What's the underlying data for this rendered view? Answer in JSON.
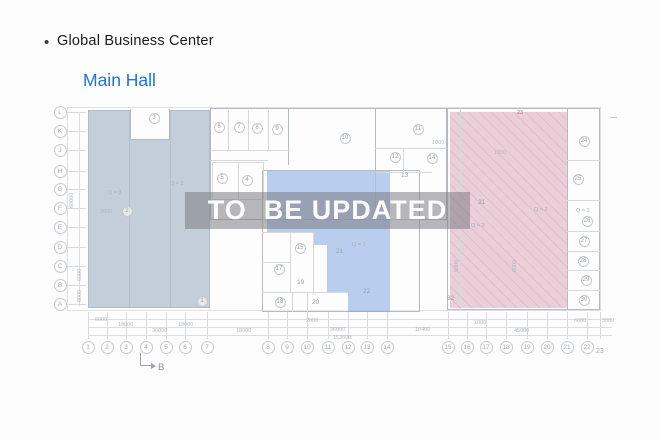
{
  "header": {
    "bullet": "•",
    "title": "Global Business Center",
    "subtitle": "Main Hall"
  },
  "watermark": {
    "text": "TO  BE UPDATED"
  },
  "colors": {
    "link_blue": "#2273cf",
    "left_region": "rgba(150,168,190,0.55)",
    "middle_region": "rgba(130,165,225,0.55)",
    "right_region": "rgba(215,160,180,0.5)",
    "watermark_band": "rgba(125,125,132,0.55)",
    "wall": "#b6bac2",
    "wall_light": "#d6d8dc",
    "accent_red": "#c36a76"
  },
  "grid": {
    "rows": [
      {
        "label": "L",
        "x": 60,
        "y": 112
      },
      {
        "label": "K",
        "x": 60,
        "y": 131
      },
      {
        "label": "J",
        "x": 60,
        "y": 150
      },
      {
        "label": "H",
        "x": 60,
        "y": 171
      },
      {
        "label": "G",
        "x": 60,
        "y": 189
      },
      {
        "label": "F",
        "x": 60,
        "y": 208
      },
      {
        "label": "E",
        "x": 60,
        "y": 227
      },
      {
        "label": "D",
        "x": 60,
        "y": 247
      },
      {
        "label": "C",
        "x": 60,
        "y": 266
      },
      {
        "label": "B",
        "x": 60,
        "y": 285
      },
      {
        "label": "A",
        "x": 60,
        "y": 304
      }
    ],
    "cols": [
      {
        "label": "1",
        "x": 88
      },
      {
        "label": "2",
        "x": 107
      },
      {
        "label": "3",
        "x": 126
      },
      {
        "label": "4",
        "x": 146
      },
      {
        "label": "5",
        "x": 166
      },
      {
        "label": "6",
        "x": 185
      },
      {
        "label": "7",
        "x": 207
      },
      {
        "label": "8",
        "x": 268
      },
      {
        "label": "9",
        "x": 287
      },
      {
        "label": "10",
        "x": 307
      },
      {
        "label": "11",
        "x": 328
      },
      {
        "label": "12",
        "x": 348
      },
      {
        "label": "13",
        "x": 367
      },
      {
        "label": "14",
        "x": 387
      },
      {
        "label": "15",
        "x": 448
      },
      {
        "label": "16",
        "x": 467
      },
      {
        "label": "17",
        "x": 486
      },
      {
        "label": "18",
        "x": 506
      },
      {
        "label": "19",
        "x": 527
      },
      {
        "label": "20",
        "x": 547
      },
      {
        "label": "21",
        "x": 567
      },
      {
        "label": "22",
        "x": 587
      },
      {
        "label": "23",
        "x": 600,
        "cy": 352,
        "plain": true
      }
    ]
  },
  "rooms": [
    {
      "n": "1",
      "x": 202,
      "y": 301,
      "c": true
    },
    {
      "n": "2",
      "x": 127,
      "y": 211,
      "c": true
    },
    {
      "n": "3",
      "x": 154,
      "y": 118,
      "c": true
    },
    {
      "n": "4",
      "x": 247,
      "y": 180,
      "c": true
    },
    {
      "n": "5",
      "x": 222,
      "y": 178,
      "c": true
    },
    {
      "n": "6",
      "x": 219,
      "y": 127,
      "c": true
    },
    {
      "n": "7",
      "x": 239,
      "y": 127,
      "c": true
    },
    {
      "n": "8",
      "x": 257,
      "y": 128,
      "c": true
    },
    {
      "n": "9",
      "x": 277,
      "y": 129,
      "c": true
    },
    {
      "n": "10",
      "x": 345,
      "y": 138,
      "c": true
    },
    {
      "n": "11",
      "x": 418,
      "y": 129,
      "c": true
    },
    {
      "n": "12",
      "x": 395,
      "y": 157,
      "c": true
    },
    {
      "n": "13",
      "x": 406,
      "y": 176,
      "c": false
    },
    {
      "n": "14",
      "x": 432,
      "y": 158,
      "c": true
    },
    {
      "n": "15",
      "x": 300,
      "y": 248,
      "c": true
    },
    {
      "n": "17",
      "x": 279,
      "y": 269,
      "c": true
    },
    {
      "n": "18",
      "x": 280,
      "y": 302,
      "c": true
    },
    {
      "n": "19",
      "x": 302,
      "y": 283,
      "c": false
    },
    {
      "n": "20",
      "x": 317,
      "y": 303,
      "c": false
    },
    {
      "n": "21",
      "x": 341,
      "y": 252,
      "c": false
    },
    {
      "n": "22",
      "x": 368,
      "y": 292,
      "c": false
    },
    {
      "n": "24",
      "x": 584,
      "y": 141,
      "c": true
    },
    {
      "n": "25",
      "x": 578,
      "y": 179,
      "c": true
    },
    {
      "n": "26",
      "x": 587,
      "y": 221,
      "c": true
    },
    {
      "n": "27",
      "x": 584,
      "y": 241,
      "c": true
    },
    {
      "n": "28",
      "x": 583,
      "y": 261,
      "c": true
    },
    {
      "n": "29",
      "x": 586,
      "y": 280,
      "c": true
    },
    {
      "n": "30",
      "x": 584,
      "y": 300,
      "c": true
    },
    {
      "n": "31",
      "x": 483,
      "y": 203,
      "c": false
    },
    {
      "n": "32",
      "x": 452,
      "y": 299,
      "c": false
    }
  ],
  "dims": [
    {
      "t": "6000",
      "x": 95,
      "y": 317
    },
    {
      "t": "18000",
      "x": 118,
      "y": 322
    },
    {
      "t": "18000",
      "x": 178,
      "y": 322
    },
    {
      "t": "36000",
      "x": 152,
      "y": 328
    },
    {
      "t": "18000",
      "x": 236,
      "y": 328
    },
    {
      "t": "2000",
      "x": 306,
      "y": 318
    },
    {
      "t": "36000",
      "x": 330,
      "y": 327
    },
    {
      "t": "18400",
      "x": 415,
      "y": 327
    },
    {
      "t": "1000",
      "x": 474,
      "y": 320
    },
    {
      "t": "45000",
      "x": 514,
      "y": 328
    },
    {
      "t": "6000",
      "x": 574,
      "y": 318
    },
    {
      "t": "3000",
      "x": 602,
      "y": 318
    },
    {
      "t": "153600",
      "x": 333,
      "y": 335
    },
    {
      "t": "60000",
      "x": 69,
      "y": 208,
      "v": true
    },
    {
      "t": "6000",
      "x": 77,
      "y": 281,
      "v": true
    },
    {
      "t": "6000",
      "x": 77,
      "y": 302,
      "v": true
    },
    {
      "t": "2000",
      "x": 100,
      "y": 209
    },
    {
      "t": "1000",
      "x": 432,
      "y": 140
    },
    {
      "t": "1000",
      "x": 494,
      "y": 150
    },
    {
      "t": "6000",
      "x": 454,
      "y": 272,
      "v": true
    },
    {
      "t": "6000",
      "x": 512,
      "y": 272,
      "v": true
    }
  ],
  "annotations": [
    {
      "t": "Q = 3",
      "x": 108,
      "y": 190
    },
    {
      "t": "Q = 3",
      "x": 170,
      "y": 181
    },
    {
      "t": "Q = 3",
      "x": 352,
      "y": 242
    },
    {
      "t": "Q = 3",
      "x": 471,
      "y": 223
    },
    {
      "t": "Q = 3",
      "x": 534,
      "y": 207
    },
    {
      "t": "Q = 3",
      "x": 576,
      "y": 208
    },
    {
      "t": "23",
      "x": 517,
      "y": 110,
      "red": true
    }
  ],
  "section_marker": {
    "label": "B"
  }
}
